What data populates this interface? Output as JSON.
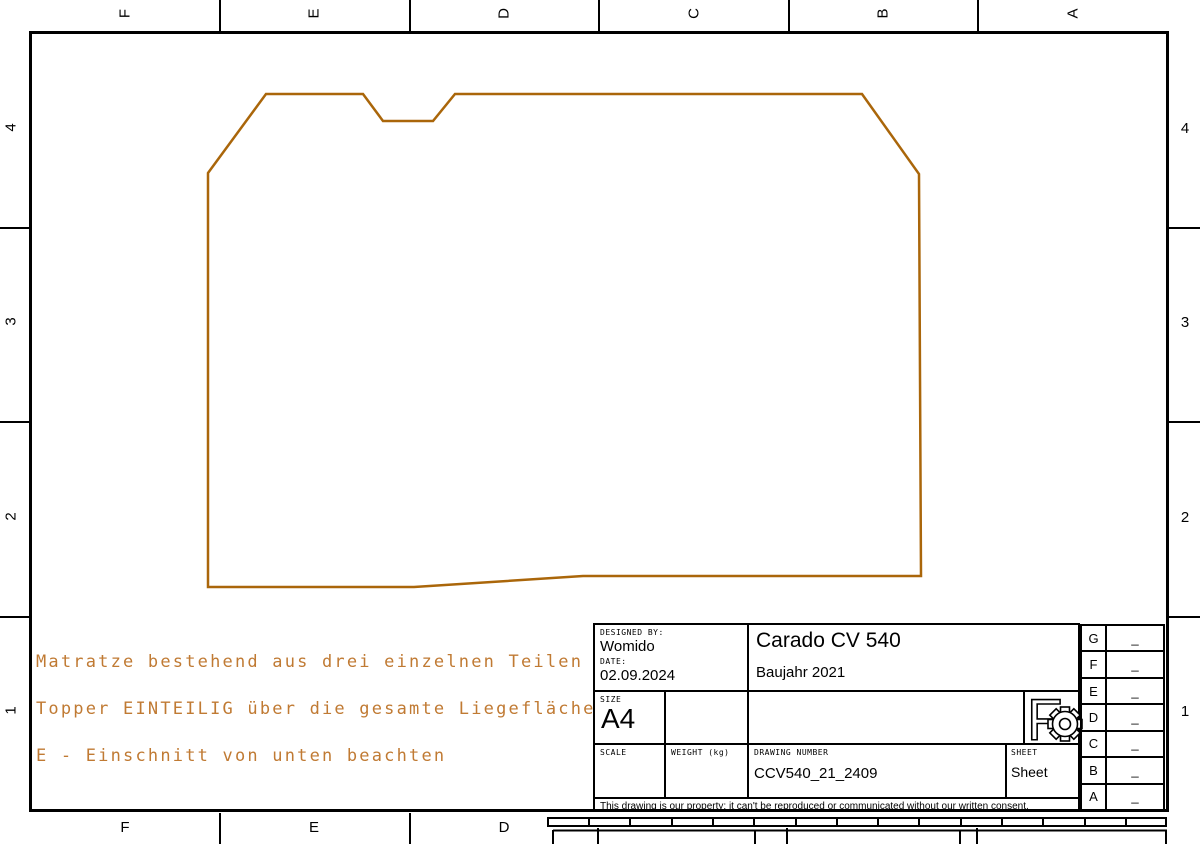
{
  "colors": {
    "outline": "#aa660a",
    "annotation_text": "#c07a33",
    "frame": "#000000",
    "background": "#ffffff"
  },
  "zones": {
    "top": [
      "F",
      "E",
      "D",
      "C",
      "B",
      "A"
    ],
    "bottom": [
      "F",
      "E",
      "D"
    ],
    "left": [
      "4",
      "3",
      "2",
      "1"
    ],
    "right": [
      "4",
      "3",
      "2",
      "1"
    ]
  },
  "annotations": {
    "line1": "Matratze bestehend aus drei einzelnen Teilen",
    "line2": "Topper EINTEILIG über die gesamte Liegefläche",
    "line3": "E - Einschnitt von unten beachten"
  },
  "shape": {
    "description": "mattress-outline-polygon",
    "outline_points": "208,173 266,94 363,94 383,121 433,121 455,94 862,94 919,174 921,576 583,576 414,587 208,587"
  },
  "title_block": {
    "designed_by_label": "DESIGNED BY:",
    "designed_by": "Womido",
    "date_label": "DATE:",
    "date": "02.09.2024",
    "title": "Carado CV 540",
    "subtitle": "Baujahr 2021",
    "size_label": "SIZE",
    "size": "A4",
    "scale_label": "SCALE",
    "weight_label": "WEIGHT (kg)",
    "drawing_number_label": "DRAWING NUMBER",
    "drawing_number": "CCV540_21_2409",
    "sheet_label": "SHEET",
    "sheet": "Sheet",
    "legal": "This drawing is our property; it can't be reproduced or communicated without our written consent.",
    "logo_letter": "F"
  },
  "revision_table": {
    "rows": [
      {
        "letter": "G",
        "value": "_"
      },
      {
        "letter": "F",
        "value": "_"
      },
      {
        "letter": "E",
        "value": "_"
      },
      {
        "letter": "D",
        "value": "_"
      },
      {
        "letter": "C",
        "value": "_"
      },
      {
        "letter": "B",
        "value": "_"
      },
      {
        "letter": "A",
        "value": "_"
      }
    ]
  }
}
